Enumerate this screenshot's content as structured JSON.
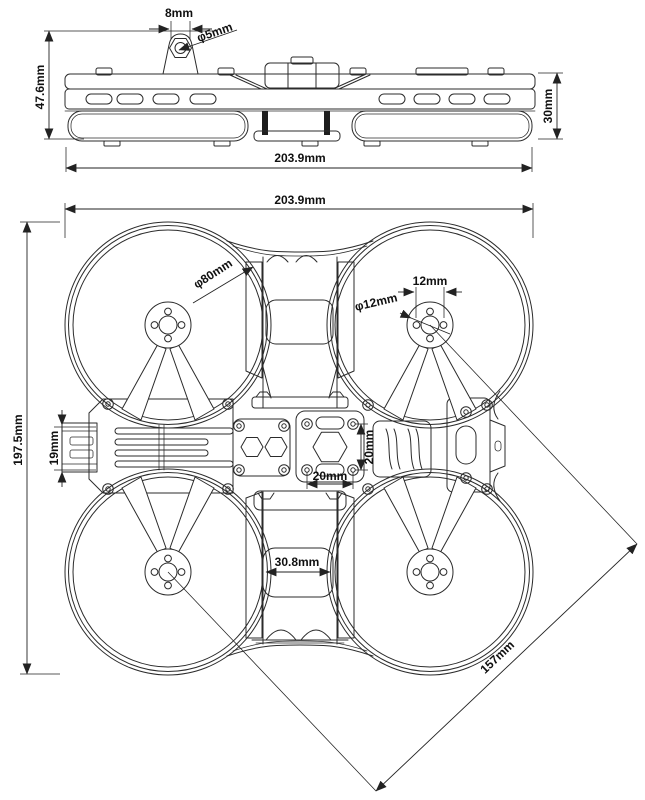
{
  "side_view": {
    "labels": {
      "tab_width": "8mm",
      "antenna_hole_diameter": "φ5mm",
      "overall_height": "47.6mm",
      "duct_height": "30mm",
      "overall_length": "203.9mm"
    }
  },
  "top_view": {
    "labels": {
      "overall_width": "203.9mm",
      "duct_diameter": "φ80mm",
      "motor_hole_spacing": "12mm",
      "motor_mount_diameter": "φ12mm",
      "overall_depth": "197.5mm",
      "camera_mount_width": "19mm",
      "stack_spacing_vertical": "20mm",
      "stack_spacing_horizontal": "20mm",
      "battery_slot_width": "30.8mm",
      "diagonal_wheelbase": "157mm"
    }
  },
  "style": {
    "line_color": "#2b2b2b",
    "text_color": "#101010",
    "background": "#ffffff"
  }
}
